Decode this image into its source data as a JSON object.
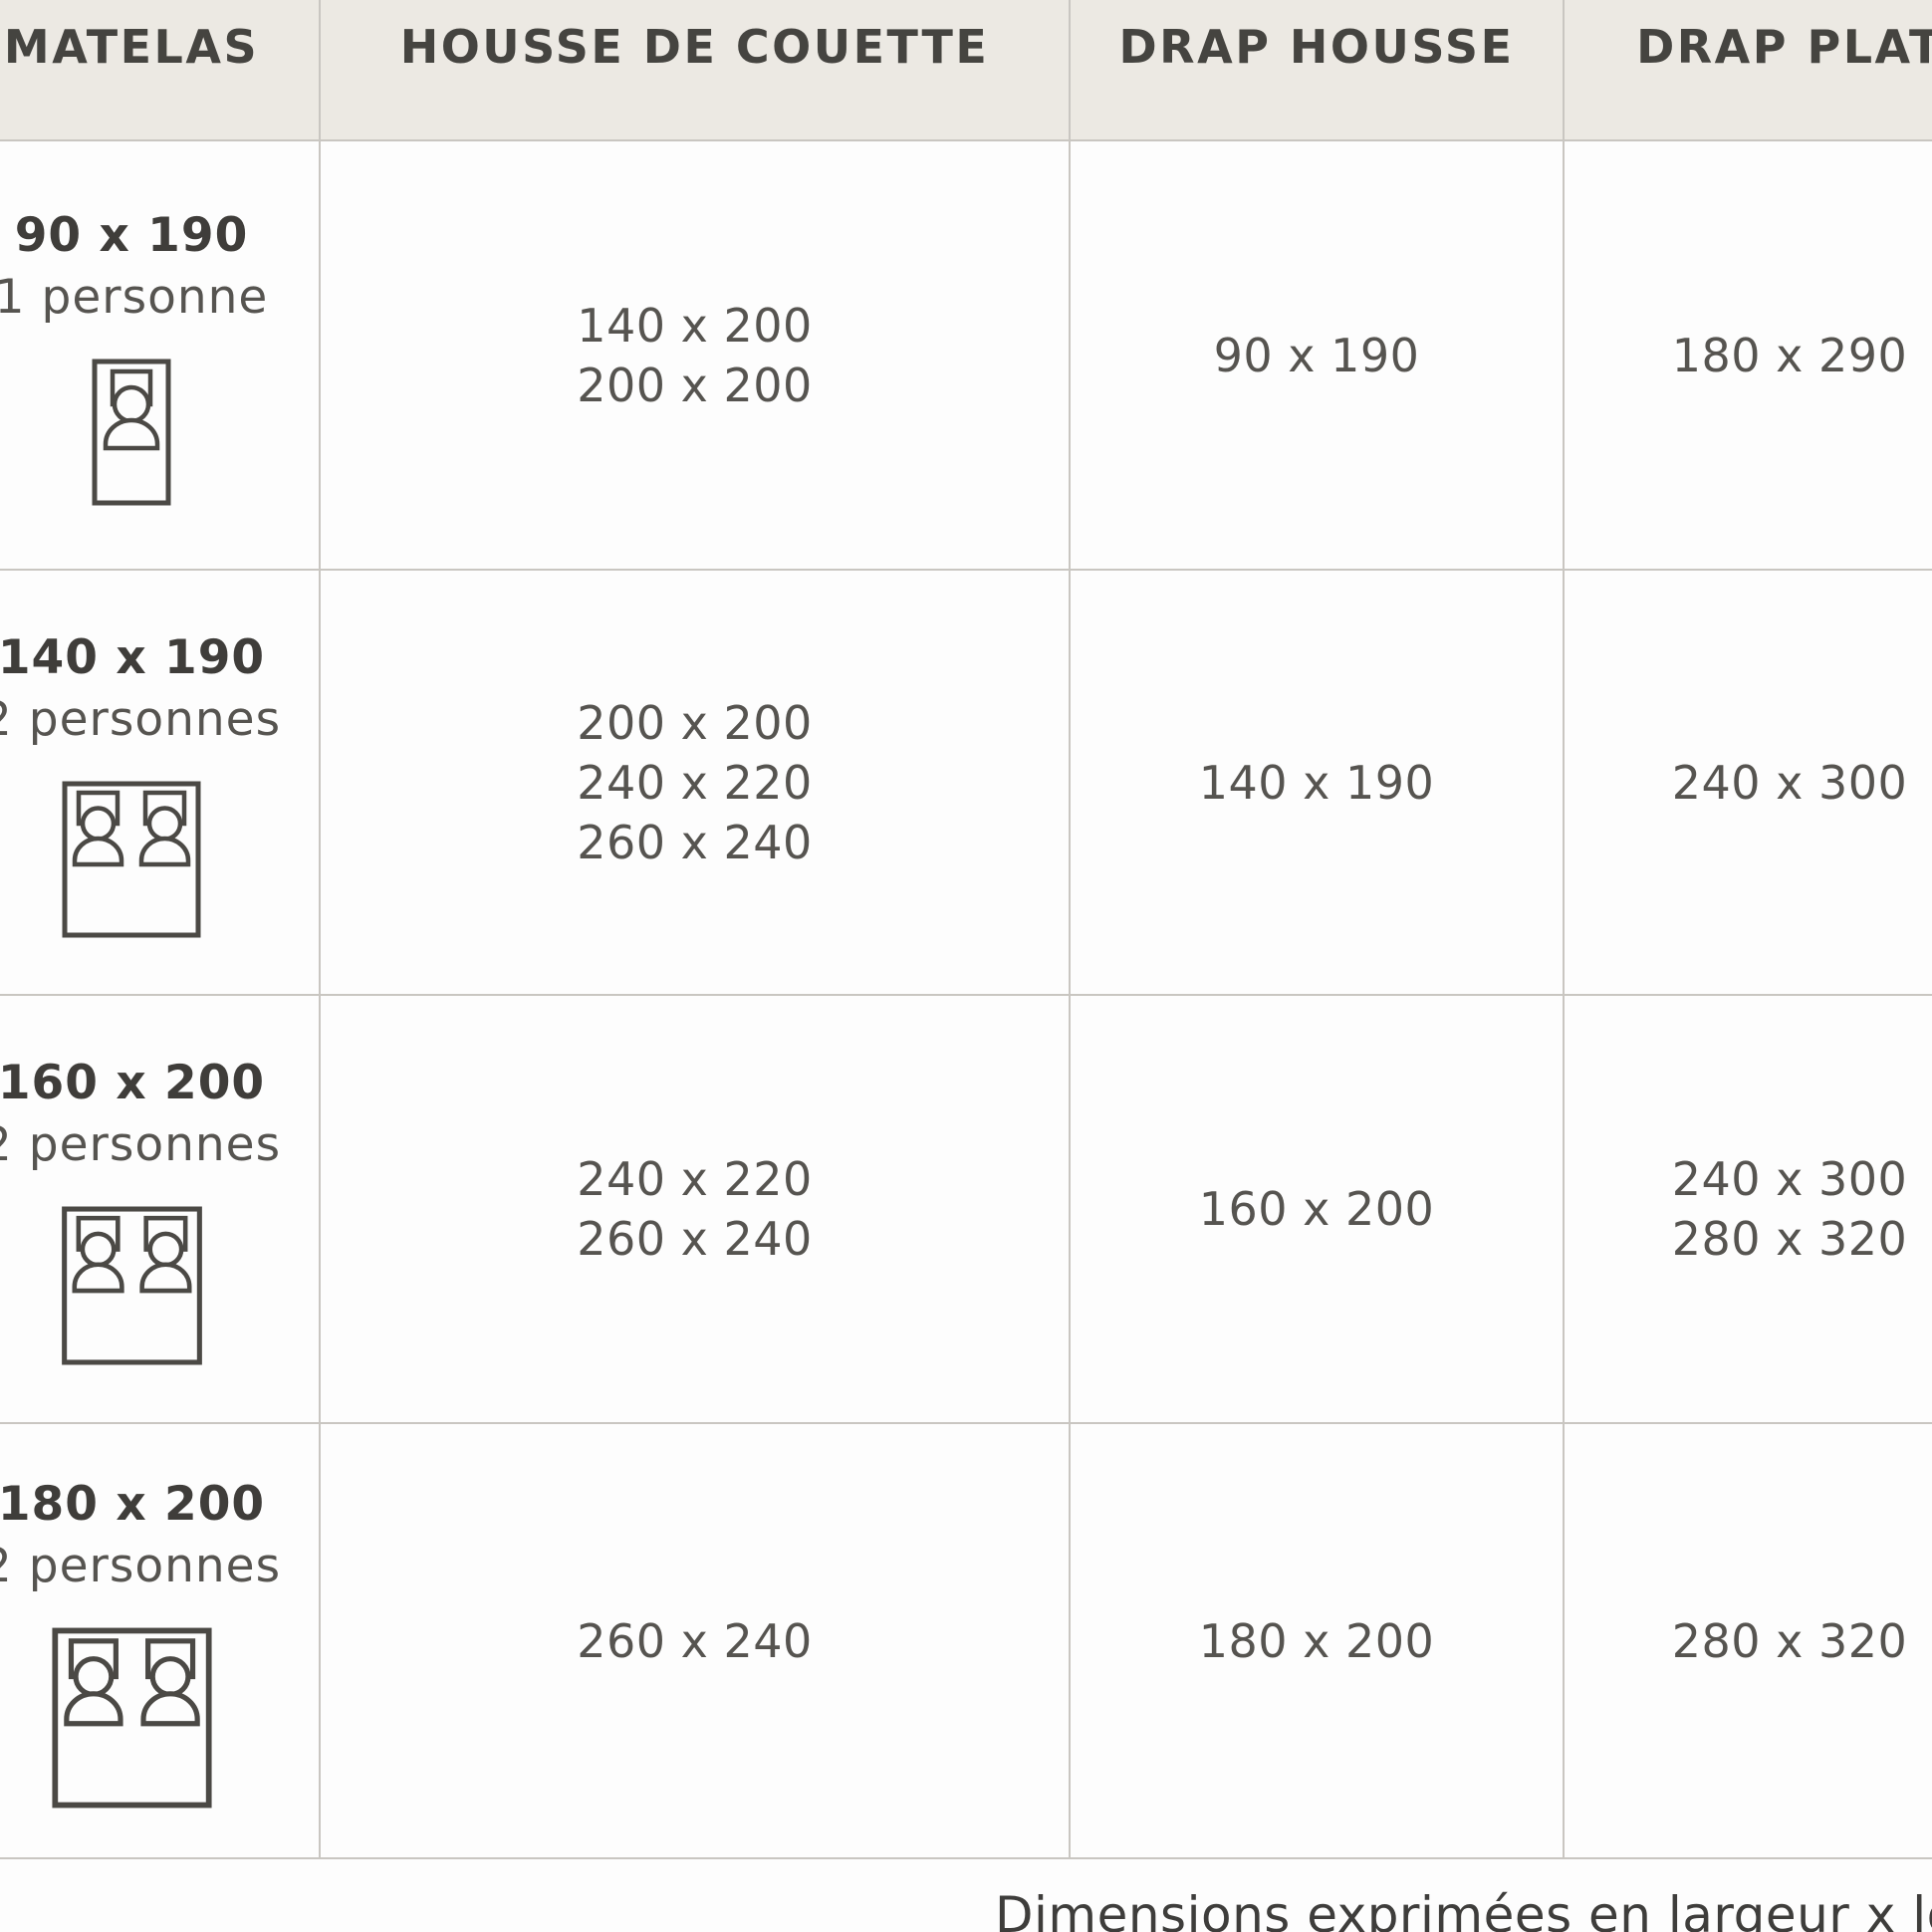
{
  "table": {
    "columns": {
      "matelas": "MATELAS",
      "housse_de_couette": "HOUSSE DE COUETTE",
      "drap_housse": "DRAP HOUSSE",
      "drap_plat": "DRAP PLAT"
    },
    "rows": [
      {
        "matelas_size": "90 x 190",
        "matelas_persons": "1 personne",
        "bed_icon": "single-bed-icon",
        "housse_de_couette": [
          "140 x 200",
          "200 x 200"
        ],
        "drap_housse": [
          "90 x 190"
        ],
        "drap_plat": [
          "180 x 290"
        ]
      },
      {
        "matelas_size": "140 x 190",
        "matelas_persons": "2 personnes",
        "bed_icon": "double-bed-icon",
        "housse_de_couette": [
          "200 x 200",
          "240 x 220",
          "260 x 240"
        ],
        "drap_housse": [
          "140 x 190"
        ],
        "drap_plat": [
          "240 x 300"
        ]
      },
      {
        "matelas_size": "160 x 200",
        "matelas_persons": "2 personnes",
        "bed_icon": "double-bed-icon",
        "housse_de_couette": [
          "240 x 220",
          "260 x 240"
        ],
        "drap_housse": [
          "160 x 200"
        ],
        "drap_plat": [
          "240 x 300",
          "280 x 320"
        ]
      },
      {
        "matelas_size": "180 x 200",
        "matelas_persons": "2 personnes",
        "bed_icon": "double-bed-icon",
        "housse_de_couette": [
          "260 x 240"
        ],
        "drap_housse": [
          "180 x 200"
        ],
        "drap_plat": [
          "280 x 320"
        ]
      }
    ],
    "footnote": "Dimensions exprimées en largeur x longueur (cm)"
  },
  "colors": {
    "header_background": "#ece9e3",
    "body_background": "#fdfdfd",
    "border": "#c9c6c1",
    "header_text": "#454440",
    "body_text": "#565450",
    "icon_stroke": "#4b4945"
  }
}
